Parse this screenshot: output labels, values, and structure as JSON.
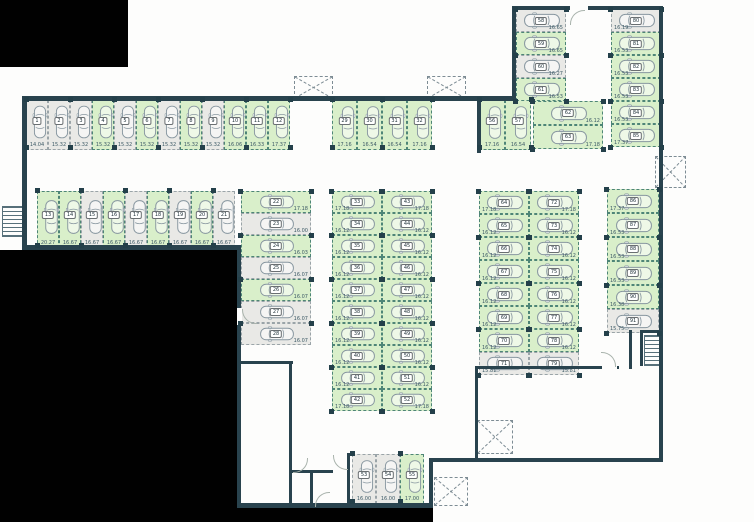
{
  "meta": {
    "title": "parking-garage-floor-plan",
    "colors": {
      "wall": "#29434e",
      "free_stall": "#d9efca",
      "occupied_stall": "#e9e9e6",
      "outside": "#010101",
      "free_dash": "#4e8577",
      "occupied_dash": "#9aa4a8"
    },
    "legend": {
      "g": "free-green-stall",
      "w": "occupied-gray-stall"
    }
  },
  "groups": [
    {
      "id": "top-row",
      "orient": "v",
      "x": 26,
      "y": 100,
      "cw": 22,
      "ch": 50,
      "dimside": "b",
      "stalls": [
        {
          "n": "1",
          "d": "14.04",
          "s": "w"
        },
        {
          "n": "2",
          "d": "15.32",
          "s": "w"
        },
        {
          "n": "3",
          "d": "15.32",
          "s": "w"
        },
        {
          "n": "4",
          "d": "15.32",
          "s": "g"
        },
        {
          "n": "5",
          "d": "15.32",
          "s": "w"
        },
        {
          "n": "6",
          "d": "15.32",
          "s": "g"
        },
        {
          "n": "7",
          "d": "15.32",
          "s": "w"
        },
        {
          "n": "8",
          "d": "15.32",
          "s": "g"
        },
        {
          "n": "9",
          "d": "15.32",
          "s": "w"
        },
        {
          "n": "10",
          "d": "16.06",
          "s": "g"
        },
        {
          "n": "11",
          "d": "16.33",
          "s": "g"
        },
        {
          "n": "12",
          "d": "17.37",
          "s": "g"
        }
      ]
    },
    {
      "id": "second-row",
      "orient": "v",
      "x": 37,
      "y": 191,
      "cw": 22,
      "ch": 57,
      "dimside": "b",
      "stalls": [
        {
          "n": "13",
          "d": "20.27",
          "s": "g"
        },
        {
          "n": "14",
          "d": "16.67",
          "s": "g"
        },
        {
          "n": "15",
          "d": "16.67",
          "s": "w"
        },
        {
          "n": "16",
          "d": "16.67",
          "s": "g"
        },
        {
          "n": "17",
          "d": "16.67",
          "s": "w"
        },
        {
          "n": "18",
          "d": "16.67",
          "s": "g"
        },
        {
          "n": "19",
          "d": "16.67",
          "s": "w"
        },
        {
          "n": "20",
          "d": "16.67",
          "s": "g"
        },
        {
          "n": "21",
          "d": "16.67",
          "s": "w"
        }
      ]
    },
    {
      "id": "left-column",
      "orient": "h",
      "x": 241,
      "y": 191,
      "cw": 70,
      "ch": 22,
      "dimside": "r",
      "stalls": [
        {
          "n": "22",
          "d": "17.18",
          "s": "g"
        },
        {
          "n": "23",
          "d": "16.00",
          "s": "w"
        },
        {
          "n": "24",
          "d": "16.03",
          "s": "g"
        },
        {
          "n": "25",
          "d": "16.07",
          "s": "w"
        },
        {
          "n": "26",
          "d": "16.07",
          "s": "g"
        },
        {
          "n": "27",
          "d": "16.07",
          "s": "w"
        },
        {
          "n": "28",
          "d": "16.07",
          "s": "w"
        }
      ]
    },
    {
      "id": "mid-top-row",
      "orient": "v",
      "x": 332,
      "y": 100,
      "cw": 25,
      "ch": 50,
      "dimside": "b",
      "stalls": [
        {
          "n": "29",
          "d": "17.16",
          "s": "g"
        },
        {
          "n": "30",
          "d": "16.54",
          "s": "g"
        },
        {
          "n": "31",
          "d": "16.54",
          "s": "g"
        },
        {
          "n": "32",
          "d": "17.16",
          "s": "g"
        }
      ]
    },
    {
      "id": "mid-col-left",
      "orient": "h",
      "x": 332,
      "y": 191,
      "cw": 50,
      "ch": 22,
      "dimside": "l",
      "stalls": [
        {
          "n": "33",
          "d": "17.18",
          "s": "g"
        },
        {
          "n": "34",
          "d": "16.12",
          "s": "g"
        },
        {
          "n": "35",
          "d": "16.12",
          "s": "g"
        },
        {
          "n": "36",
          "d": "16.12",
          "s": "g"
        },
        {
          "n": "37",
          "d": "16.12",
          "s": "g"
        },
        {
          "n": "38",
          "d": "16.12",
          "s": "g"
        },
        {
          "n": "39",
          "d": "16.12",
          "s": "g"
        },
        {
          "n": "40",
          "d": "16.12",
          "s": "g"
        },
        {
          "n": "41",
          "d": "16.12",
          "s": "g"
        },
        {
          "n": "42",
          "d": "17.18",
          "s": "g"
        }
      ]
    },
    {
      "id": "mid-col-right",
      "orient": "h",
      "x": 382,
      "y": 191,
      "cw": 50,
      "ch": 22,
      "dimside": "r",
      "stalls": [
        {
          "n": "43",
          "d": "17.18",
          "s": "g"
        },
        {
          "n": "44",
          "d": "16.12",
          "s": "g"
        },
        {
          "n": "45",
          "d": "16.12",
          "s": "g"
        },
        {
          "n": "46",
          "d": "16.12",
          "s": "g"
        },
        {
          "n": "47",
          "d": "16.12",
          "s": "g"
        },
        {
          "n": "48",
          "d": "16.12",
          "s": "g"
        },
        {
          "n": "49",
          "d": "16.12",
          "s": "g"
        },
        {
          "n": "50",
          "d": "16.12",
          "s": "g"
        },
        {
          "n": "51",
          "d": "16.12",
          "s": "g"
        },
        {
          "n": "52",
          "d": "17.18",
          "s": "g"
        }
      ]
    },
    {
      "id": "bottom-row",
      "orient": "v",
      "x": 352,
      "y": 454,
      "cw": 24,
      "ch": 50,
      "dimside": "b",
      "stalls": [
        {
          "n": "53",
          "d": "16.00",
          "s": "w"
        },
        {
          "n": "54",
          "d": "16.00",
          "s": "w"
        },
        {
          "n": "55",
          "d": "17.00",
          "s": "g"
        }
      ]
    },
    {
      "id": "right-top-pair",
      "orient": "v",
      "x": 479,
      "y": 100,
      "cw": 26,
      "ch": 50,
      "dimside": "b",
      "stalls": [
        {
          "n": "56",
          "d": "17.16",
          "s": "g"
        },
        {
          "n": "57",
          "d": "16.54",
          "s": "g"
        }
      ]
    },
    {
      "id": "upper-col-left",
      "orient": "h",
      "x": 516,
      "y": 9,
      "cw": 50,
      "ch": 23,
      "dimside": "r",
      "stalls": [
        {
          "n": "58",
          "d": "16.65",
          "s": "w"
        },
        {
          "n": "59",
          "d": "16.65",
          "s": "g"
        },
        {
          "n": "60",
          "d": "16.27",
          "s": "w"
        },
        {
          "n": "61",
          "d": "16.53",
          "s": "g"
        }
      ]
    },
    {
      "id": "upper-pair-h",
      "orient": "h",
      "x": 533,
      "y": 101,
      "cw": 70,
      "ch": 24,
      "dimside": "r",
      "stalls": [
        {
          "n": "62",
          "d": "16.12",
          "s": "g"
        },
        {
          "n": "63",
          "d": "17.18",
          "s": "g"
        }
      ]
    },
    {
      "id": "right-col-left",
      "orient": "h",
      "x": 479,
      "y": 191,
      "cw": 50,
      "ch": 23,
      "dimside": "l",
      "stalls": [
        {
          "n": "64",
          "d": "17.18",
          "s": "g"
        },
        {
          "n": "65",
          "d": "16.12",
          "s": "g"
        },
        {
          "n": "66",
          "d": "16.12",
          "s": "g"
        },
        {
          "n": "67",
          "d": "16.12",
          "s": "g"
        },
        {
          "n": "68",
          "d": "16.12",
          "s": "g"
        },
        {
          "n": "69",
          "d": "16.12",
          "s": "g"
        },
        {
          "n": "70",
          "d": "16.12",
          "s": "g"
        },
        {
          "n": "71",
          "d": "15.81",
          "s": "w"
        }
      ]
    },
    {
      "id": "right-col-right",
      "orient": "h",
      "x": 529,
      "y": 191,
      "cw": 50,
      "ch": 23,
      "dimside": "r",
      "stalls": [
        {
          "n": "72",
          "d": "17.18",
          "s": "g"
        },
        {
          "n": "73",
          "d": "16.12",
          "s": "g"
        },
        {
          "n": "74",
          "d": "16.12",
          "s": "g"
        },
        {
          "n": "75",
          "d": "16.12",
          "s": "g"
        },
        {
          "n": "76",
          "d": "16.12",
          "s": "g"
        },
        {
          "n": "77",
          "d": "16.12",
          "s": "g"
        },
        {
          "n": "78",
          "d": "16.12",
          "s": "g"
        },
        {
          "n": "79",
          "d": "15.81",
          "s": "w"
        }
      ]
    },
    {
      "id": "upper-col-right",
      "orient": "h",
      "x": 611,
      "y": 9,
      "cw": 50,
      "ch": 23,
      "dimside": "l",
      "stalls": [
        {
          "n": "80",
          "d": "16.19",
          "s": "w"
        },
        {
          "n": "81",
          "d": "16.53",
          "s": "g"
        },
        {
          "n": "82",
          "d": "16.53",
          "s": "g"
        },
        {
          "n": "83",
          "d": "16.53",
          "s": "g"
        },
        {
          "n": "84",
          "d": "16.53",
          "s": "g"
        },
        {
          "n": "85",
          "d": "17.37",
          "s": "g"
        }
      ]
    },
    {
      "id": "far-right-col",
      "orient": "h",
      "x": 607,
      "y": 189,
      "cw": 52,
      "ch": 24,
      "dimside": "l",
      "stalls": [
        {
          "n": "86",
          "d": "17.37",
          "s": "g"
        },
        {
          "n": "87",
          "d": "16.53",
          "s": "g"
        },
        {
          "n": "88",
          "d": "16.53",
          "s": "g"
        },
        {
          "n": "89",
          "d": "16.53",
          "s": "g"
        },
        {
          "n": "90",
          "d": "16.38",
          "s": "g"
        },
        {
          "n": "91",
          "d": "15.75",
          "s": "w"
        }
      ]
    }
  ]
}
